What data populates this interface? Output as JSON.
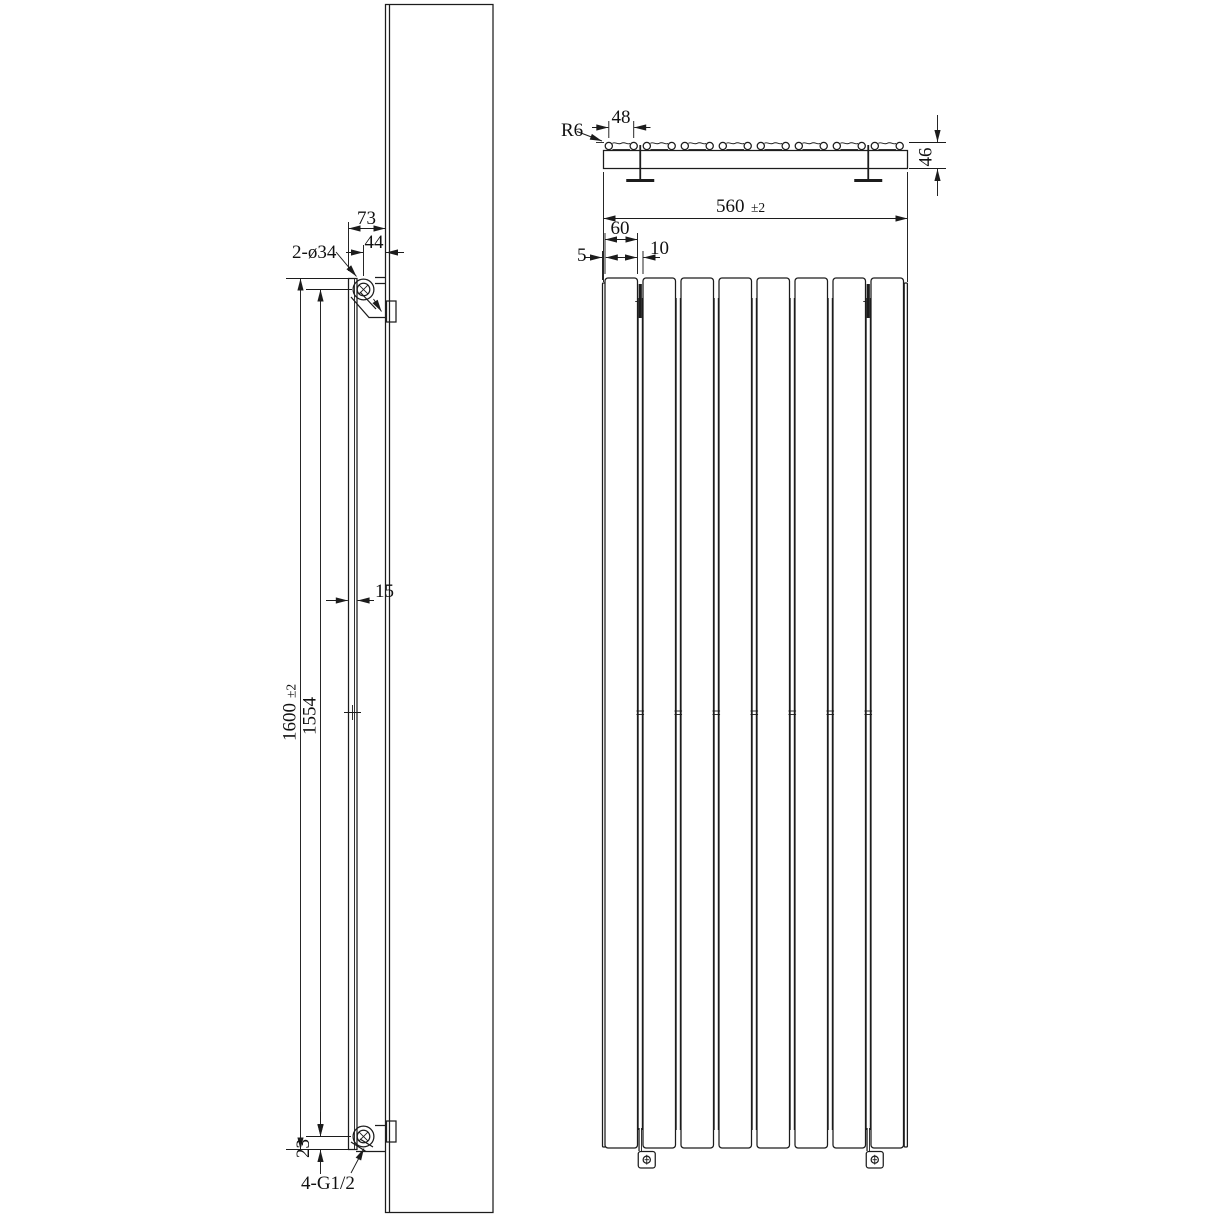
{
  "drawing": {
    "side_view": {
      "hole_callout": "2-ø34",
      "dim_front_to_wall": "73",
      "dim_hole_to_wall": "44",
      "dim_panel_thickness": "15",
      "dim_overall_height_value": "1600",
      "dim_overall_height_tol": "±2",
      "dim_hole_spacing": "1554",
      "dim_hole_to_bottom": "23",
      "thread_callout": "4-G1/2"
    },
    "top_view": {
      "radius_callout": "R6",
      "dim_tube_flat": "48",
      "dim_depth": "46",
      "tube_count": 8
    },
    "front_view": {
      "dim_overall_width_value": "560",
      "dim_overall_width_tol": "±2",
      "dim_panel_width": "60",
      "dim_edge_margin": "5",
      "dim_panel_gap": "10",
      "panel_count": 8,
      "gap_count": 7
    }
  }
}
